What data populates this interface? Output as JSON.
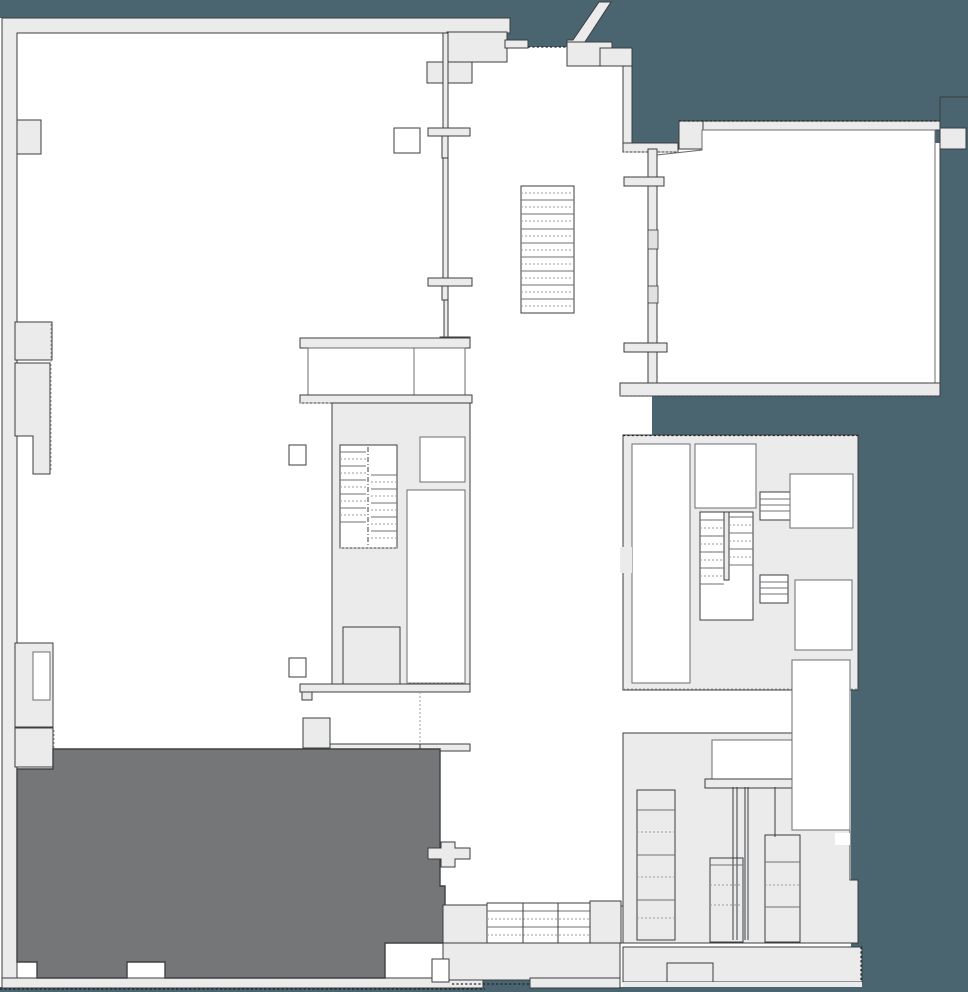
{
  "title": "building-floor-plan",
  "colors": {
    "background": "#4a6470",
    "floor": "#ffffff",
    "wall": "#ebebeb",
    "outline": "#3b3d3f",
    "highlight": "#747678",
    "highlight_outline": "#3f4143",
    "tread": "#6f7173",
    "dotted": "#9e9e9e"
  },
  "regions": [
    {
      "id": "highlighted-room",
      "state": "selected"
    },
    {
      "id": "main-hall",
      "state": "normal"
    },
    {
      "id": "upper-right-room",
      "state": "normal"
    },
    {
      "id": "central-stair-core",
      "state": "normal"
    },
    {
      "id": "right-stair-core",
      "state": "normal"
    },
    {
      "id": "main-staircase",
      "state": "normal"
    },
    {
      "id": "escalator-bank",
      "state": "normal"
    },
    {
      "id": "lower-right-block",
      "state": "normal"
    },
    {
      "id": "entry-vestibule",
      "state": "normal"
    }
  ]
}
